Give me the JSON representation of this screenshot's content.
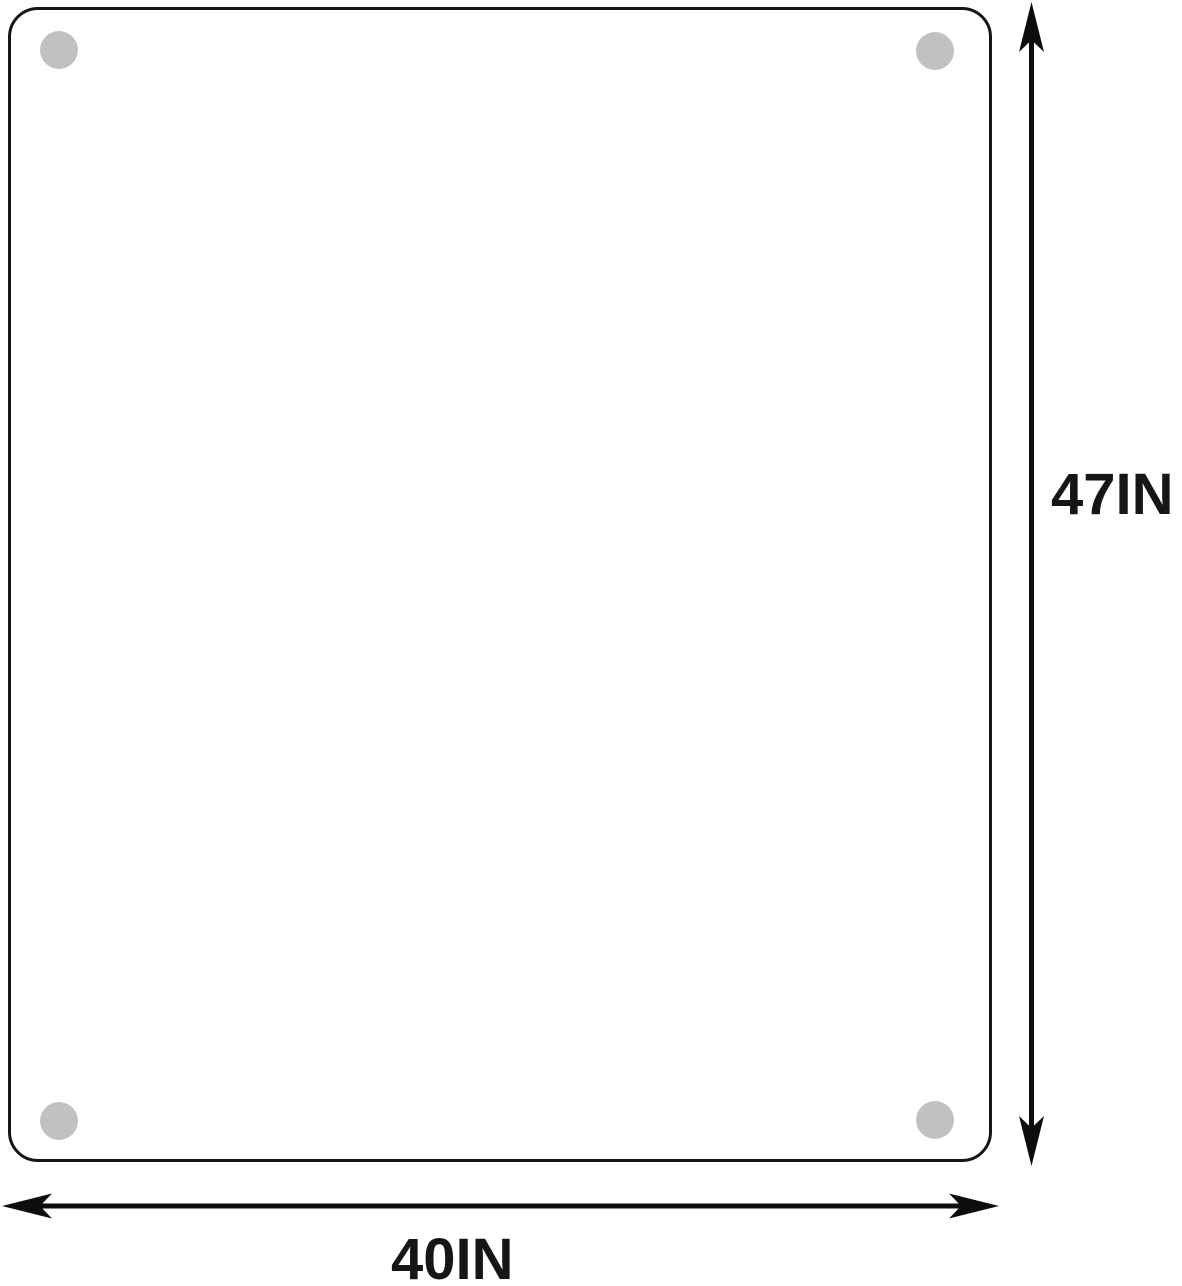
{
  "diagram": {
    "type": "product-dimension-diagram",
    "height_dimension": {
      "label": "47IN"
    },
    "width_dimension": {
      "label": "40IN"
    }
  },
  "icons": {
    "height_arrow": "vertical-double-headed-arrow",
    "width_arrow": "horizontal-double-headed-arrow",
    "corner_pads": "gray-circle-pad"
  },
  "colors": {
    "background": "#ffffff",
    "outline": "#161616",
    "arrow": "#0d0d0d",
    "pad": "#c1c1c1",
    "label_text": "#161616"
  }
}
